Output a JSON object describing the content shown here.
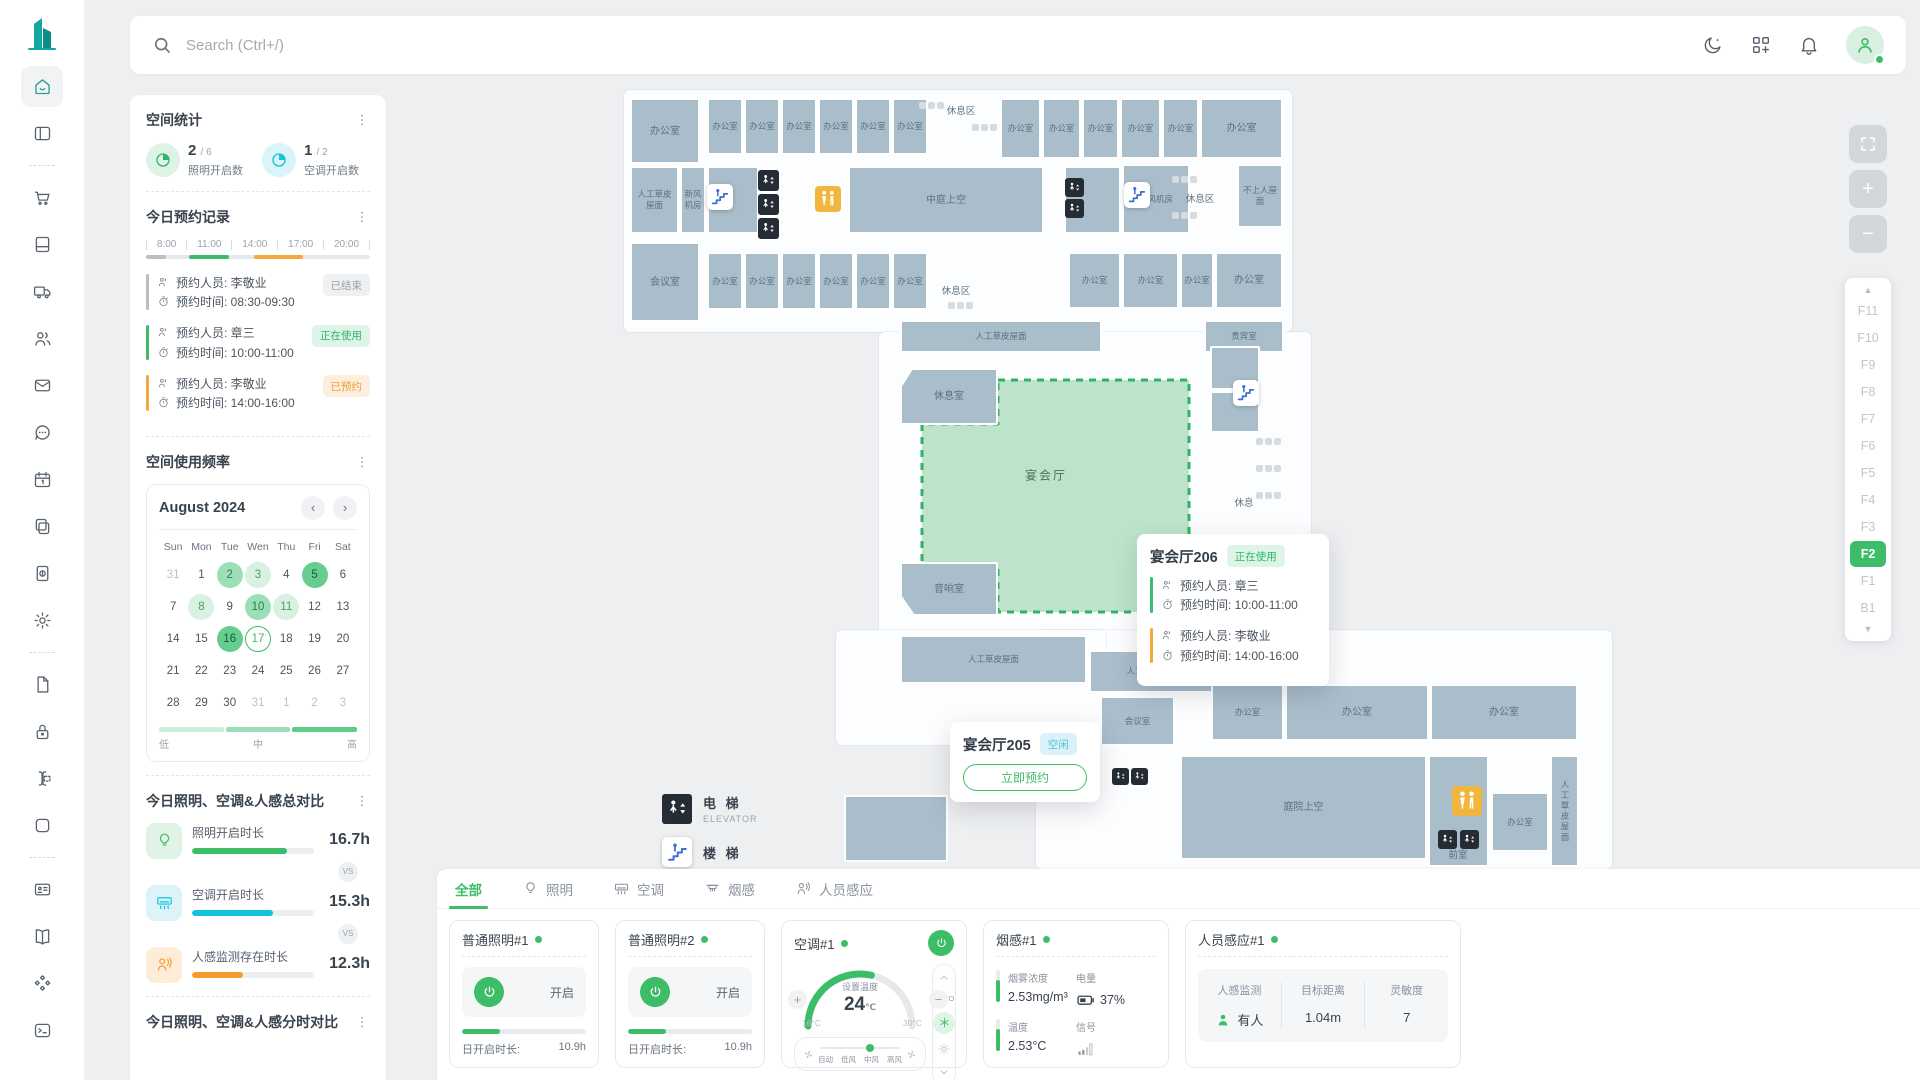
{
  "topbar": {
    "search_placeholder": "Search (Ctrl+/)",
    "notification_count": "4",
    "icons": [
      "moon-icon",
      "apps-grid-icon",
      "bell-icon",
      "avatar"
    ]
  },
  "sidebar": {
    "items": [
      {
        "icon": "home",
        "active": true
      },
      {
        "icon": "layout"
      },
      {
        "divider": true
      },
      {
        "icon": "cart"
      },
      {
        "icon": "book"
      },
      {
        "icon": "truck"
      },
      {
        "icon": "users"
      },
      {
        "icon": "mail"
      },
      {
        "icon": "chat"
      },
      {
        "icon": "calendar"
      },
      {
        "icon": "copy"
      },
      {
        "icon": "receipt"
      },
      {
        "icon": "gear"
      },
      {
        "divider": true
      },
      {
        "icon": "file"
      },
      {
        "icon": "lock"
      },
      {
        "icon": "cursor"
      },
      {
        "icon": "square"
      },
      {
        "divider": true
      },
      {
        "icon": "idcard"
      },
      {
        "icon": "bookopen"
      },
      {
        "icon": "shapes"
      },
      {
        "icon": "terminal"
      }
    ]
  },
  "space_stats": {
    "title": "空间统计",
    "items": [
      {
        "value": "2",
        "frac": "/ 6",
        "label": "照明开启数",
        "color": "green"
      },
      {
        "value": "1",
        "frac": "/ 2",
        "label": "空调开启数",
        "color": "cyan"
      }
    ]
  },
  "reservations": {
    "title": "今日预约记录",
    "person_label": "预约人员:",
    "time_label": "预约时间:",
    "ticks": [
      "8:00",
      "11:00",
      "14:00",
      "17:00",
      "20:00"
    ],
    "segments": [
      {
        "left": 0,
        "width": 9,
        "color": "#b9bfc6"
      },
      {
        "left": 19,
        "width": 18,
        "color": "#3dbd67"
      },
      {
        "left": 48,
        "width": 22,
        "color": "#f5a83c"
      }
    ],
    "records": [
      {
        "person": "李敬业",
        "time": "08:30-09:30",
        "status": "已结束",
        "type": "ended",
        "color": "#b9bfc6"
      },
      {
        "person": "章三",
        "time": "10:00-11:00",
        "status": "正在使用",
        "type": "active",
        "color": "#3dbd67"
      },
      {
        "person": "李敬业",
        "time": "14:00-16:00",
        "status": "已预约",
        "type": "booked",
        "color": "#f5a83c"
      }
    ]
  },
  "usage": {
    "title": "空间使用频率",
    "month": "August 2024",
    "prev": "‹",
    "next": "›",
    "weekdays": [
      "Sun",
      "Mon",
      "Tue",
      "Wen",
      "Thu",
      "Fri",
      "Sat"
    ],
    "weeks": [
      [
        {
          "d": "31",
          "out": true
        },
        {
          "d": "1"
        },
        {
          "d": "2",
          "lv": "mid"
        },
        {
          "d": "3",
          "lv": "low"
        },
        {
          "d": "4"
        },
        {
          "d": "5",
          "lv": "high"
        },
        {
          "d": "6"
        }
      ],
      [
        {
          "d": "7"
        },
        {
          "d": "8",
          "lv": "low"
        },
        {
          "d": "9"
        },
        {
          "d": "10",
          "lv": "mid"
        },
        {
          "d": "11",
          "lv": "low"
        },
        {
          "d": "12"
        },
        {
          "d": "13"
        }
      ],
      [
        {
          "d": "14"
        },
        {
          "d": "15"
        },
        {
          "d": "16",
          "lv": "high"
        },
        {
          "d": "17",
          "sel": true
        },
        {
          "d": "18"
        },
        {
          "d": "19"
        },
        {
          "d": "20"
        }
      ],
      [
        {
          "d": "21"
        },
        {
          "d": "22"
        },
        {
          "d": "23"
        },
        {
          "d": "24"
        },
        {
          "d": "25"
        },
        {
          "d": "26"
        },
        {
          "d": "27"
        }
      ],
      [
        {
          "d": "28"
        },
        {
          "d": "29"
        },
        {
          "d": "30"
        },
        {
          "d": "31",
          "out": true
        },
        {
          "d": "1",
          "out": true
        },
        {
          "d": "2",
          "out": true
        },
        {
          "d": "3",
          "out": true
        }
      ]
    ],
    "legend": {
      "low": "低",
      "mid": "中",
      "high": "高",
      "colors": [
        "#cdeeda",
        "#9cdfb6",
        "#5fcc89"
      ]
    }
  },
  "compare": {
    "title": "今日照明、空调&人感总对比",
    "vs": "VS",
    "rows": [
      {
        "icon": "bulb",
        "label": "照明开启时长",
        "value": "16.7h",
        "pct": 78,
        "color": "#3dbd67",
        "bg": "#e0f3e6"
      },
      {
        "icon": "ac",
        "label": "空调开启时长",
        "value": "15.3h",
        "pct": 66,
        "color": "#14c3db",
        "bg": "#dcf4f9"
      },
      {
        "icon": "presence",
        "label": "人感监测存在时长",
        "value": "12.3h",
        "pct": 42,
        "color": "#f59b2c",
        "bg": "#fdecd8"
      }
    ]
  },
  "hourly": {
    "title": "今日照明、空调&人感分时对比"
  },
  "map": {
    "hall_label": "宴会厅",
    "rooms": [
      {
        "x": 206,
        "y": 8,
        "w": 70,
        "h": 66,
        "t": "办公室"
      },
      {
        "x": 283,
        "y": 8,
        "w": 36,
        "h": 57,
        "t": "办公室",
        "c": "sm"
      },
      {
        "x": 320,
        "y": 8,
        "w": 36,
        "h": 57,
        "t": "办公室",
        "c": "sm"
      },
      {
        "x": 357,
        "y": 8,
        "w": 36,
        "h": 57,
        "t": "办公室",
        "c": "sm"
      },
      {
        "x": 394,
        "y": 8,
        "w": 36,
        "h": 57,
        "t": "办公室",
        "c": "sm"
      },
      {
        "x": 431,
        "y": 8,
        "w": 36,
        "h": 57,
        "t": "办公室",
        "c": "sm"
      },
      {
        "x": 468,
        "y": 8,
        "w": 36,
        "h": 57,
        "t": "办公室",
        "c": "sm"
      },
      {
        "x": 576,
        "y": 8,
        "w": 41,
        "h": 61,
        "t": "办公室",
        "c": "sm"
      },
      {
        "x": 618,
        "y": 8,
        "w": 39,
        "h": 61,
        "t": "办公室",
        "c": "sm"
      },
      {
        "x": 658,
        "y": 8,
        "w": 37,
        "h": 61,
        "t": "办公室",
        "c": "sm"
      },
      {
        "x": 696,
        "y": 8,
        "w": 41,
        "h": 61,
        "t": "办公室",
        "c": "sm"
      },
      {
        "x": 738,
        "y": 8,
        "w": 37,
        "h": 61,
        "t": "办公室",
        "c": "sm"
      },
      {
        "x": 776,
        "y": 8,
        "w": 83,
        "h": 61,
        "t": "办公室"
      },
      {
        "x": 206,
        "y": 76,
        "w": 49,
        "h": 68,
        "t": "人工草皮屋面",
        "c": "sm"
      },
      {
        "x": 256,
        "y": 76,
        "w": 26,
        "h": 68,
        "t": "新风机房",
        "c": "sm"
      },
      {
        "x": 283,
        "y": 76,
        "w": 52,
        "h": 68,
        "t": ""
      },
      {
        "x": 424,
        "y": 76,
        "w": 196,
        "h": 68,
        "t": "中庭上空"
      },
      {
        "x": 640,
        "y": 76,
        "w": 57,
        "h": 68,
        "t": ""
      },
      {
        "x": 698,
        "y": 74,
        "w": 68,
        "h": 70,
        "t": "新风机房",
        "c": "sm"
      },
      {
        "x": 813,
        "y": 74,
        "w": 46,
        "h": 64,
        "t": "不上人屋面",
        "c": "sm"
      },
      {
        "x": 206,
        "y": 152,
        "w": 70,
        "h": 80,
        "t": "会议室"
      },
      {
        "x": 283,
        "y": 162,
        "w": 36,
        "h": 58,
        "t": "办公室",
        "c": "sm"
      },
      {
        "x": 320,
        "y": 162,
        "w": 36,
        "h": 58,
        "t": "办公室",
        "c": "sm"
      },
      {
        "x": 357,
        "y": 162,
        "w": 36,
        "h": 58,
        "t": "办公室",
        "c": "sm"
      },
      {
        "x": 394,
        "y": 162,
        "w": 36,
        "h": 58,
        "t": "办公室",
        "c": "sm"
      },
      {
        "x": 431,
        "y": 162,
        "w": 36,
        "h": 58,
        "t": "办公室",
        "c": "sm"
      },
      {
        "x": 468,
        "y": 162,
        "w": 36,
        "h": 58,
        "t": "办公室",
        "c": "sm"
      },
      {
        "x": 644,
        "y": 162,
        "w": 53,
        "h": 57,
        "t": "办公室",
        "c": "sm"
      },
      {
        "x": 698,
        "y": 162,
        "w": 57,
        "h": 57,
        "t": "办公室",
        "c": "sm"
      },
      {
        "x": 756,
        "y": 162,
        "w": 34,
        "h": 57,
        "t": "办公室",
        "c": "sm"
      },
      {
        "x": 791,
        "y": 162,
        "w": 68,
        "h": 57,
        "t": "办公室"
      },
      {
        "x": 476,
        "y": 230,
        "w": 202,
        "h": 33,
        "t": "人工草皮屋面",
        "c": "sm"
      },
      {
        "x": 780,
        "y": 230,
        "w": 80,
        "h": 33,
        "t": "贵宾室",
        "c": "sm"
      },
      {
        "x": 476,
        "y": 278,
        "w": 98,
        "h": 57,
        "t": "休息室",
        "c": "notch-tl"
      },
      {
        "x": 476,
        "y": 472,
        "w": 98,
        "h": 54,
        "t": "音响室",
        "c": "notch-bl"
      },
      {
        "x": 786,
        "y": 256,
        "w": 50,
        "h": 44,
        "t": ""
      },
      {
        "x": 786,
        "y": 301,
        "w": 50,
        "h": 42,
        "t": ""
      },
      {
        "x": 476,
        "y": 545,
        "w": 187,
        "h": 49,
        "t": "人工草皮屋面",
        "c": "sm"
      },
      {
        "x": 665,
        "y": 560,
        "w": 126,
        "h": 43,
        "t": "人工草皮屋面",
        "c": "sm"
      },
      {
        "x": 676,
        "y": 606,
        "w": 75,
        "h": 50,
        "t": "会议室",
        "c": "sm"
      },
      {
        "x": 787,
        "y": 594,
        "w": 73,
        "h": 57,
        "t": "办公室",
        "c": "sm"
      },
      {
        "x": 861,
        "y": 594,
        "w": 144,
        "h": 57,
        "t": "办公室"
      },
      {
        "x": 1006,
        "y": 594,
        "w": 148,
        "h": 57,
        "t": "办公室"
      },
      {
        "x": 756,
        "y": 665,
        "w": 247,
        "h": 105,
        "t": "庭院上空"
      },
      {
        "x": 1004,
        "y": 665,
        "w": 61,
        "h": 112,
        "t": ""
      },
      {
        "x": 1067,
        "y": 702,
        "w": 58,
        "h": 60,
        "t": "办公室",
        "c": "sm"
      },
      {
        "x": 1126,
        "y": 665,
        "w": 29,
        "h": 112,
        "t": "人工草皮屋面",
        "c": "vert"
      },
      {
        "x": 420,
        "y": 705,
        "w": 104,
        "h": 67,
        "t": ""
      }
    ],
    "labels": [
      {
        "t": "休息区",
        "x": 537,
        "y": 20
      },
      {
        "t": "休息区",
        "x": 776,
        "y": 108
      },
      {
        "t": "休息区",
        "x": 532,
        "y": 200
      },
      {
        "t": "休息",
        "x": 820,
        "y": 412
      },
      {
        "t": "前室",
        "x": 1034,
        "y": 764
      },
      {
        "t": "宴会厅",
        "x": 622,
        "y": 385,
        "c": "hall"
      }
    ],
    "icons": [
      {
        "t": "elevator",
        "x": 334,
        "y": 80,
        "s": 21
      },
      {
        "t": "elevator",
        "x": 334,
        "y": 104,
        "s": 21
      },
      {
        "t": "elevator",
        "x": 334,
        "y": 128,
        "s": 21
      },
      {
        "t": "elevator",
        "x": 641,
        "y": 88,
        "s": 19
      },
      {
        "t": "elevator",
        "x": 641,
        "y": 109,
        "s": 19
      },
      {
        "t": "restroom",
        "x": 391,
        "y": 96,
        "s": 26
      },
      {
        "t": "stairs",
        "x": 283,
        "y": 94,
        "s": 26
      },
      {
        "t": "stairs",
        "x": 700,
        "y": 92,
        "s": 26
      },
      {
        "t": "stairs",
        "x": 809,
        "y": 290,
        "s": 26
      },
      {
        "t": "restroom",
        "x": 799,
        "y": 572,
        "s": 20
      },
      {
        "t": "restroom",
        "x": 1028,
        "y": 696,
        "s": 30
      },
      {
        "t": "elevator",
        "x": 1014,
        "y": 740,
        "s": 19
      },
      {
        "t": "elevator",
        "x": 1036,
        "y": 740,
        "s": 19
      },
      {
        "t": "elevator",
        "x": 688,
        "y": 678,
        "s": 17
      },
      {
        "t": "elevator",
        "x": 707,
        "y": 678,
        "s": 17
      },
      {
        "t": "furn",
        "x": 495,
        "y": 12
      },
      {
        "t": "furn",
        "x": 548,
        "y": 34
      },
      {
        "t": "furn",
        "x": 748,
        "y": 86
      },
      {
        "t": "furn",
        "x": 748,
        "y": 122
      },
      {
        "t": "furn",
        "x": 524,
        "y": 212
      },
      {
        "t": "furn",
        "x": 832,
        "y": 348
      },
      {
        "t": "furn",
        "x": 832,
        "y": 375
      },
      {
        "t": "furn",
        "x": 832,
        "y": 402
      },
      {
        "t": "furn",
        "x": 830,
        "y": 465
      }
    ],
    "tooltip_206": {
      "title": "宴会厅206",
      "status": "正在使用",
      "status_type": "active",
      "entries": [
        {
          "person": "章三",
          "time": "10:00-11:00",
          "color": "#3dbd67"
        },
        {
          "person": "李敬业",
          "time": "14:00-16:00",
          "color": "#f5a83c"
        }
      ]
    },
    "tooltip_205": {
      "title": "宴会厅205",
      "status": "空闲",
      "status_type": "idle",
      "button": "立即预约"
    },
    "legend": [
      {
        "icon": "elevator",
        "zh": "电 梯",
        "en": "ELEVATOR"
      },
      {
        "icon": "stairs",
        "zh": "楼 梯",
        "en": ""
      }
    ],
    "floors": {
      "list": [
        "F11",
        "F10",
        "F9",
        "F8",
        "F7",
        "F6",
        "F5",
        "F4",
        "F3",
        "F2",
        "F1",
        "B1"
      ],
      "selected": "F2"
    },
    "zoom_controls": {
      "fullscreen": "⛶",
      "zoom_in": "+",
      "zoom_out": "−"
    }
  },
  "devices": {
    "tabs": [
      {
        "label": "全部",
        "icon": null,
        "active": true
      },
      {
        "label": "照明",
        "icon": "bulb"
      },
      {
        "label": "空调",
        "icon": "ac"
      },
      {
        "label": "烟感",
        "icon": "smoke"
      },
      {
        "label": "人员感应",
        "icon": "presence"
      }
    ],
    "cards": {
      "light1": {
        "title": "普通照明#1",
        "state": "开启",
        "pct": 31,
        "duration_label": "日开启时长:",
        "duration": "10.9h"
      },
      "light2": {
        "title": "普通照明#2",
        "state": "开启",
        "pct": 31,
        "duration_label": "日开启时长:",
        "duration": "10.9h"
      },
      "ac": {
        "title": "空调#1",
        "gauge_label": "设置温度",
        "temp": "24",
        "unit": "℃",
        "min": "16°C",
        "max": "30°C",
        "fans": [
          "自动",
          "低风",
          "中风",
          "高风"
        ],
        "fan_dot_pct": 58,
        "mode_auto": "AUTO"
      },
      "smoke": {
        "title": "烟感#1",
        "m1_label": "烟雾浓度",
        "m1": "2.53mg/m³",
        "m2_label": "电量",
        "m2": "37%",
        "m3_label": "温度",
        "m3": "2.53°C",
        "m4_label": "信号"
      },
      "presence": {
        "title": "人员感应#1",
        "c1_label": "人感监测",
        "c1": "有人",
        "c2_label": "目标距离",
        "c2": "1.04m",
        "c3_label": "灵敏度",
        "c3": "7"
      }
    }
  }
}
